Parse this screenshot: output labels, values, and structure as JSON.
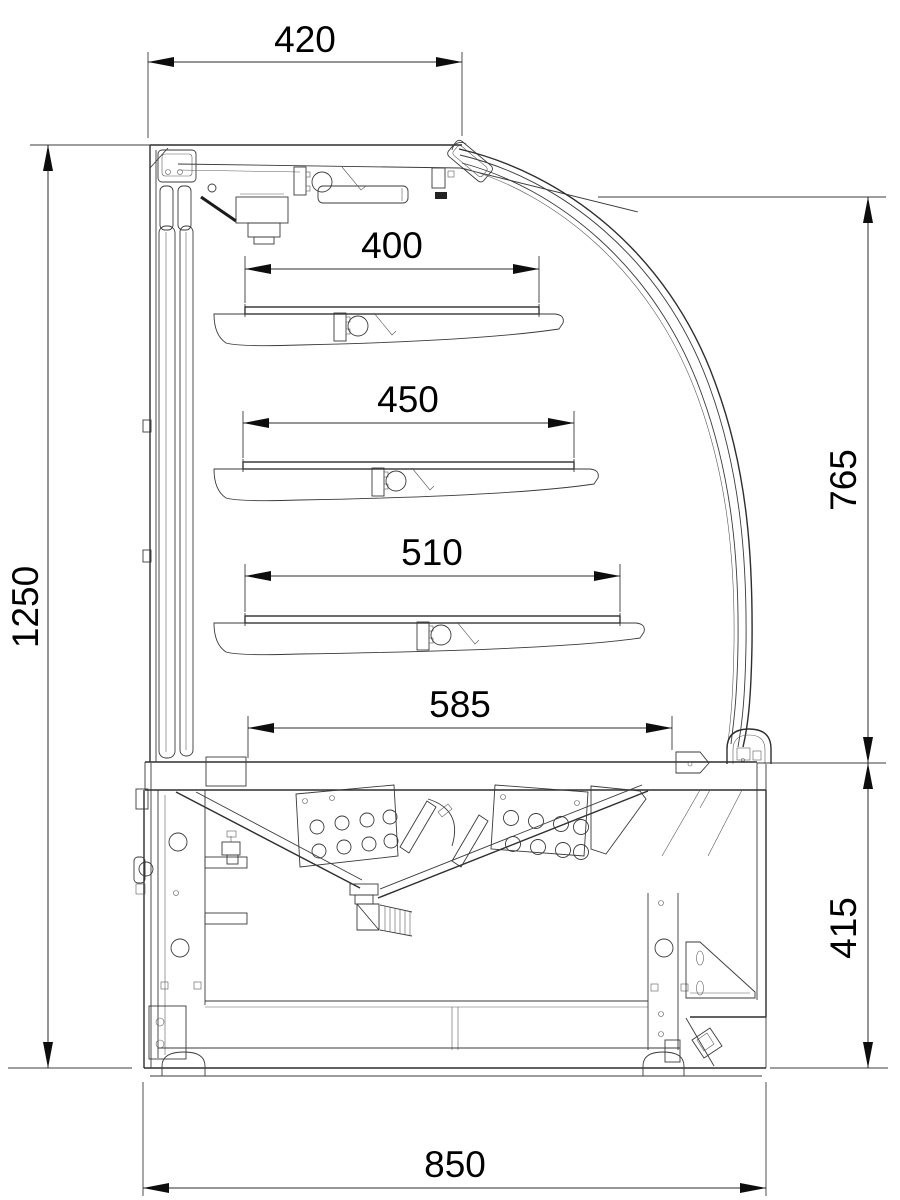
{
  "drawing": {
    "subject": "curved-glass refrigerated display case — side cross-section",
    "units": "mm",
    "colors": {
      "background": "#ffffff",
      "line": "#333333",
      "dimension_text": "#000000"
    },
    "dimensions": {
      "canopy_depth": {
        "value": "420",
        "orientation": "horizontal"
      },
      "shelf_1_depth": {
        "value": "400",
        "orientation": "horizontal"
      },
      "shelf_2_depth": {
        "value": "450",
        "orientation": "horizontal"
      },
      "shelf_3_depth": {
        "value": "510",
        "orientation": "horizontal"
      },
      "base_deck_depth": {
        "value": "585",
        "orientation": "horizontal"
      },
      "overall_height": {
        "value": "1250",
        "orientation": "vertical"
      },
      "glass_front_height": {
        "value": "765",
        "orientation": "vertical"
      },
      "base_height": {
        "value": "415",
        "orientation": "vertical"
      },
      "overall_depth": {
        "value": "850",
        "orientation": "horizontal"
      }
    }
  }
}
